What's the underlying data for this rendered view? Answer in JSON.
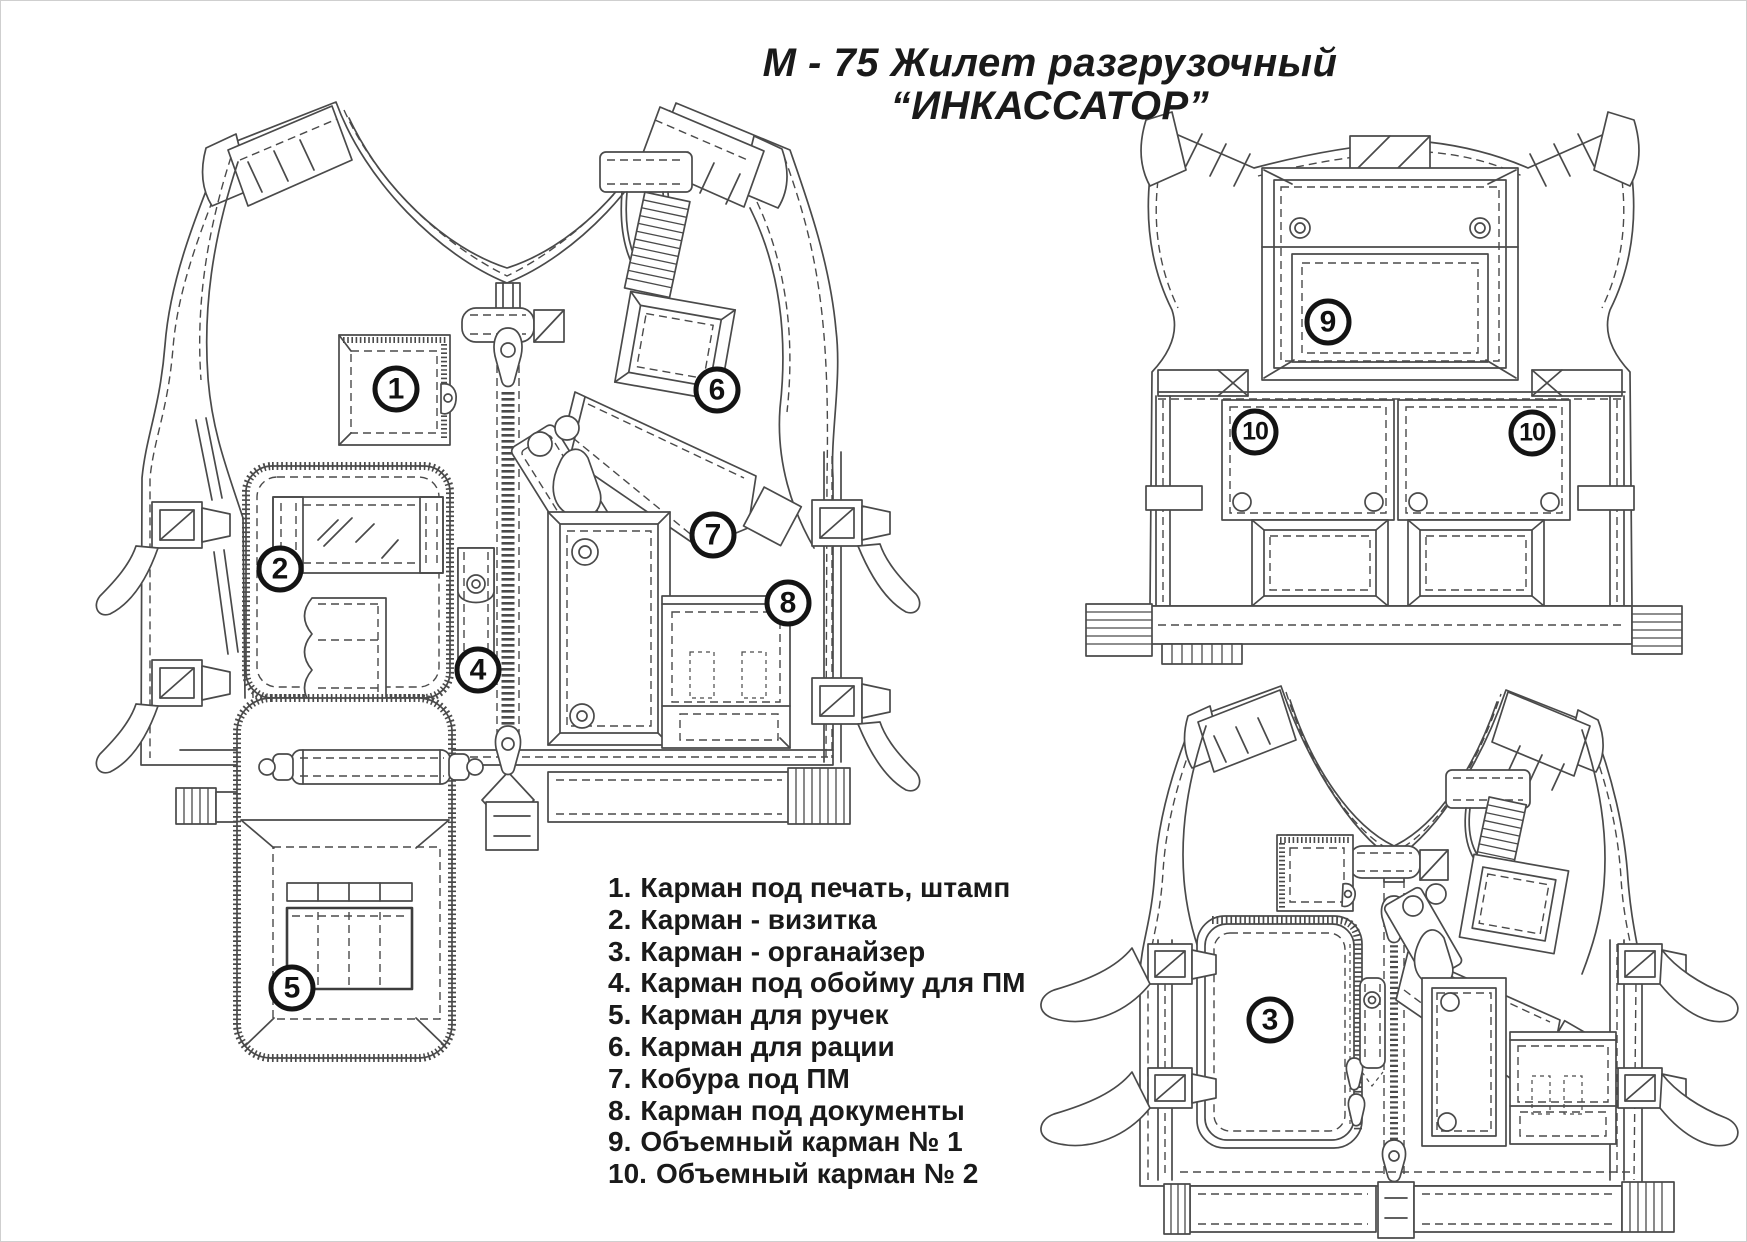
{
  "title": {
    "line1": "М - 75 Жилет разгрузочный",
    "line2": "“ИНКАССАТОР”"
  },
  "legend": {
    "items": [
      {
        "num": "1.",
        "label": "Карман под печать, штамп"
      },
      {
        "num": "2.",
        "label": "Карман - визитка"
      },
      {
        "num": "3.",
        "label": "Карман - органайзер"
      },
      {
        "num": "4.",
        "label": "Карман под обойму для ПМ"
      },
      {
        "num": "5.",
        "label": "Карман для ручек"
      },
      {
        "num": "6.",
        "label": "Карман для рации"
      },
      {
        "num": "7.",
        "label": "Кобура под ПМ"
      },
      {
        "num": "8.",
        "label": "Карман под документы"
      },
      {
        "num": "9.",
        "label": "Объемный карман № 1"
      },
      {
        "num": "10.",
        "label": "Объемный карман № 2"
      }
    ]
  },
  "callouts": [
    {
      "n": "1",
      "x": 396,
      "y": 389
    },
    {
      "n": "2",
      "x": 280,
      "y": 569
    },
    {
      "n": "4",
      "x": 478,
      "y": 670
    },
    {
      "n": "5",
      "x": 292,
      "y": 988
    },
    {
      "n": "6",
      "x": 717,
      "y": 390
    },
    {
      "n": "7",
      "x": 713,
      "y": 535
    },
    {
      "n": "8",
      "x": 788,
      "y": 603
    },
    {
      "n": "9",
      "x": 1328,
      "y": 322
    },
    {
      "n": "10",
      "x": 1255,
      "y": 432
    },
    {
      "n": "10",
      "x": 1532,
      "y": 433
    },
    {
      "n": "3",
      "x": 1270,
      "y": 1020
    }
  ],
  "colors": {
    "line": "#4a4a4a",
    "callout_ring": "#141414",
    "text": "#1a1a1a",
    "background": "#ffffff"
  }
}
